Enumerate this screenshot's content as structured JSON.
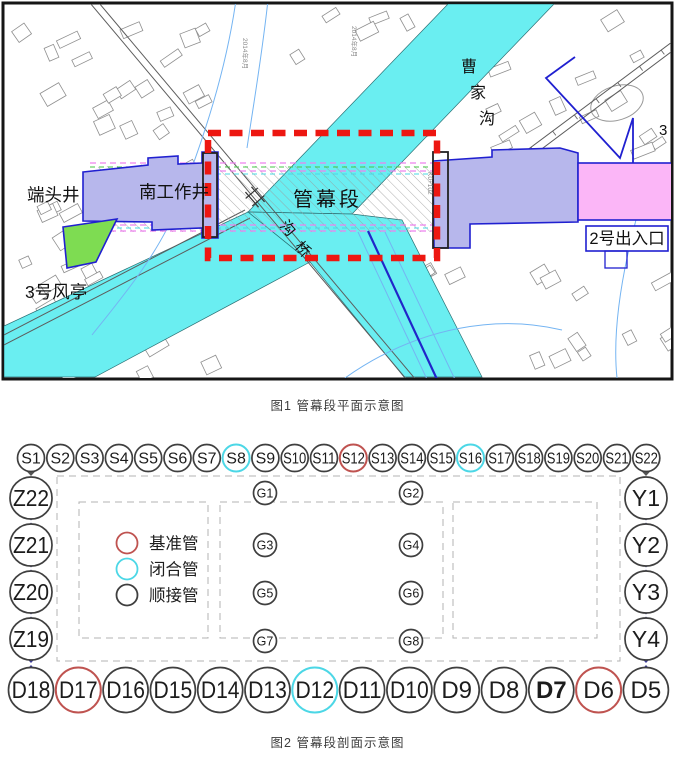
{
  "figure1": {
    "caption": "图1 管幕段平面示意图",
    "labels": {
      "end_shaft": "端头井",
      "south_working_shaft": "南工作井",
      "pipe_curtain": "管幕段",
      "exit2": "2号出入口",
      "vent3": "3号风亭",
      "right_edge_num": "3"
    },
    "river_chars": [
      "曹",
      "家",
      "沟"
    ],
    "bridge_chars": [
      "沟",
      "桥"
    ],
    "decor_texts": [
      "2014年8月",
      "2014年8月",
      "K0+102"
    ],
    "colors": {
      "water": "#6aeef1",
      "structure": "#b7b7ec",
      "exit": "#fbb6f7",
      "green_area": "#7edc52",
      "blue_outline": "#2020d0",
      "red_dash": "#ed1711"
    }
  },
  "figure2": {
    "caption": "图2 管幕段剖面示意图",
    "legend": [
      {
        "label": "基准管",
        "type": "datum"
      },
      {
        "label": "闭合管",
        "type": "closed"
      },
      {
        "label": "顺接管",
        "type": "normal"
      }
    ],
    "type_colors": {
      "datum": "#bf5350",
      "closed": "#4cd7e6",
      "normal": "#3f3f3f"
    },
    "connector_color": "#3c3c96",
    "first_connector_color": "#3dbb3d",
    "corner_connector_color": "#555555",
    "top_row": [
      {
        "label": "S1",
        "type": "normal"
      },
      {
        "label": "S2",
        "type": "normal"
      },
      {
        "label": "S3",
        "type": "normal"
      },
      {
        "label": "S4",
        "type": "normal"
      },
      {
        "label": "S5",
        "type": "normal"
      },
      {
        "label": "S6",
        "type": "normal"
      },
      {
        "label": "S7",
        "type": "normal"
      },
      {
        "label": "S8",
        "type": "closed"
      },
      {
        "label": "S9",
        "type": "normal"
      },
      {
        "label": "S10",
        "type": "normal"
      },
      {
        "label": "S11",
        "type": "normal"
      },
      {
        "label": "S12",
        "type": "datum"
      },
      {
        "label": "S13",
        "type": "normal"
      },
      {
        "label": "S14",
        "type": "normal"
      },
      {
        "label": "S15",
        "type": "normal"
      },
      {
        "label": "S16",
        "type": "closed"
      },
      {
        "label": "S17",
        "type": "normal"
      },
      {
        "label": "S18",
        "type": "normal"
      },
      {
        "label": "S19",
        "type": "normal"
      },
      {
        "label": "S20",
        "type": "normal"
      },
      {
        "label": "S21",
        "type": "normal"
      },
      {
        "label": "S22",
        "type": "normal"
      }
    ],
    "left_col": [
      {
        "label": "Z22",
        "type": "normal"
      },
      {
        "label": "Z21",
        "type": "normal"
      },
      {
        "label": "Z20",
        "type": "normal"
      },
      {
        "label": "Z19",
        "type": "normal"
      }
    ],
    "right_col": [
      {
        "label": "Y1",
        "type": "normal"
      },
      {
        "label": "Y2",
        "type": "normal"
      },
      {
        "label": "Y3",
        "type": "normal"
      },
      {
        "label": "Y4",
        "type": "normal"
      }
    ],
    "bottom_row": [
      {
        "label": "D18",
        "type": "normal"
      },
      {
        "label": "D17",
        "type": "datum"
      },
      {
        "label": "D16",
        "type": "normal"
      },
      {
        "label": "D15",
        "type": "normal"
      },
      {
        "label": "D14",
        "type": "normal"
      },
      {
        "label": "D13",
        "type": "normal"
      },
      {
        "label": "D12",
        "type": "closed"
      },
      {
        "label": "D11",
        "type": "normal"
      },
      {
        "label": "D10",
        "type": "normal"
      },
      {
        "label": "D9",
        "type": "normal"
      },
      {
        "label": "D8",
        "type": "normal"
      },
      {
        "label": "D7",
        "type": "normal",
        "bold": true
      },
      {
        "label": "D6",
        "type": "datum"
      },
      {
        "label": "D5",
        "type": "normal"
      }
    ],
    "guide_pipes": [
      {
        "label": "G1"
      },
      {
        "label": "G2"
      },
      {
        "label": "G3"
      },
      {
        "label": "G4"
      },
      {
        "label": "G5"
      },
      {
        "label": "G6"
      },
      {
        "label": "G7"
      },
      {
        "label": "G8"
      }
    ]
  }
}
